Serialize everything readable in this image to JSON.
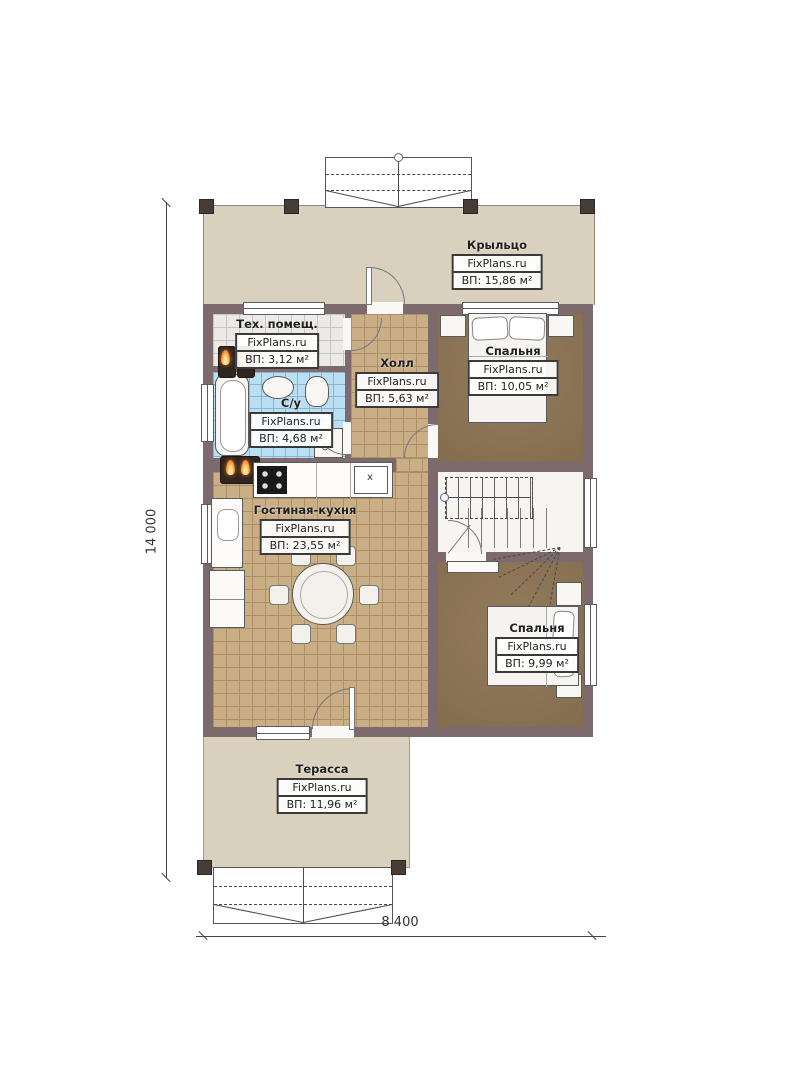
{
  "page": {
    "type": "floor-plan",
    "watermark": "FixPlans.ru"
  },
  "dimensions": {
    "left": "14 000",
    "bottom": "8 400"
  },
  "rooms": [
    {
      "name": "Крыльцо",
      "brand": "FixPlans.ru",
      "area": "ВП: 15,86 м²"
    },
    {
      "name": "Тех. помещ.",
      "brand": "FixPlans.ru",
      "area": "ВП: 3,12 м²"
    },
    {
      "name": "Холл",
      "brand": "FixPlans.ru",
      "area": "ВП: 5,63 м²"
    },
    {
      "name": "С/у",
      "brand": "FixPlans.ru",
      "area": "ВП: 4,68 м²"
    },
    {
      "name": "Спальня",
      "brand": "FixPlans.ru",
      "area": "ВП: 10,05 м²"
    },
    {
      "name": "Гостиная-кухня",
      "brand": "FixPlans.ru",
      "area": "ВП: 23,55 м²"
    },
    {
      "name": "Спальня",
      "brand": "FixPlans.ru",
      "area": "ВП: 9,99 м²"
    },
    {
      "name": "Терасса",
      "brand": "FixPlans.ru",
      "area": "ВП: 11,96 м²"
    }
  ],
  "appliances": {
    "washing_machine_label": "Ст.М",
    "cooktop_mark": "x"
  },
  "colors": {
    "wall": "#7d6a6c",
    "porch_floor": "#d9d0bd",
    "tile_floor": "#c9ae86",
    "bedroom_floor": "#8b7356",
    "bath_floor": "#badef2",
    "tech_floor": "#eceae7",
    "flame": "#e8731f",
    "label_border": "#3a3a3a"
  }
}
